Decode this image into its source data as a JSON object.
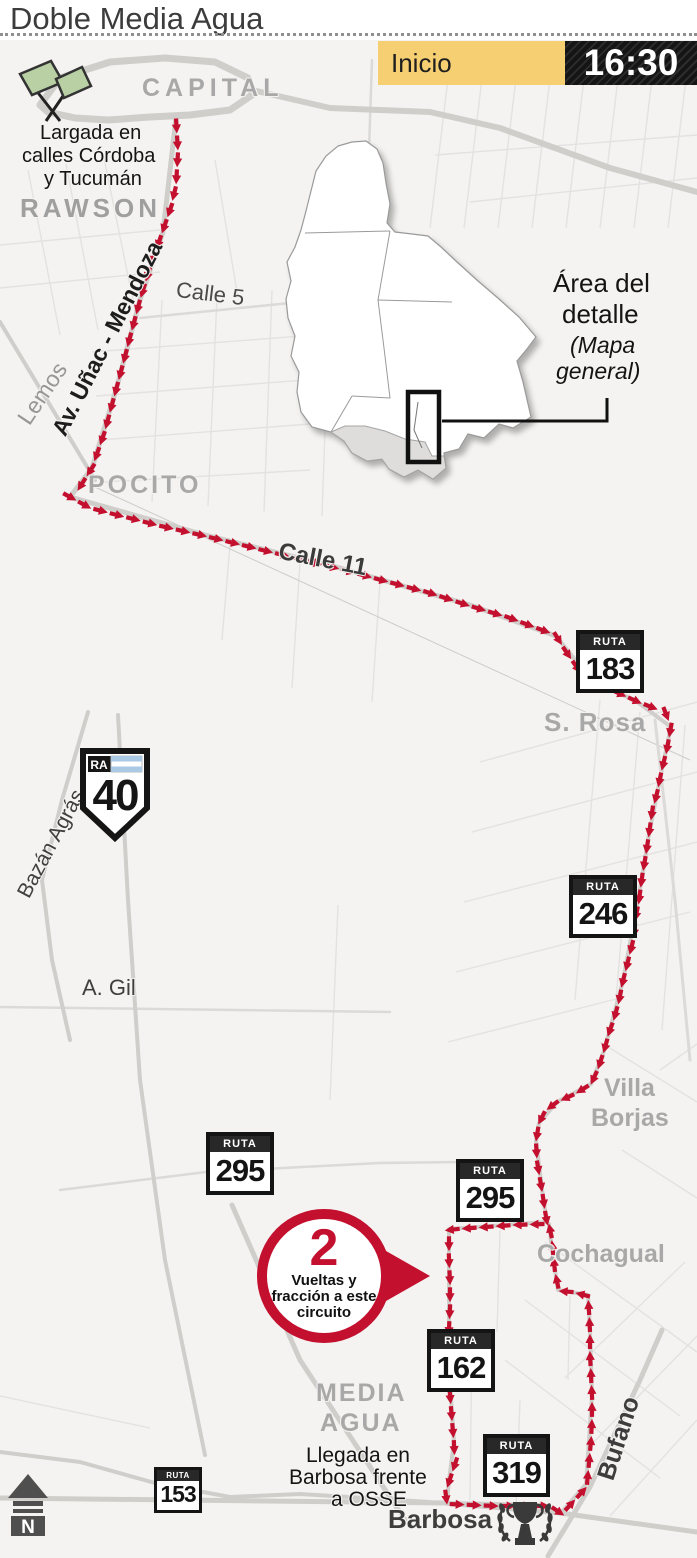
{
  "title": "Doble Media Agua",
  "schedule": {
    "label": "Inicio",
    "time": "16:30"
  },
  "areas": {
    "capital": "CAPITAL",
    "rawson": "RAWSON",
    "pocito": "POCITO",
    "santa_rosa": "S. Rosa",
    "villa_borjas_line1": "Villa",
    "villa_borjas_line2": "Borjas",
    "cochagual": "Cochagual",
    "media_agua_line1": "MEDIA",
    "media_agua_line2": "AGUA",
    "barbosa": "Barbosa"
  },
  "streets": {
    "calle5": "Calle 5",
    "calle11": "Calle 11",
    "lemos": "Lemos",
    "unac": "Av. Uñac - Mendoza",
    "bazan": "Bazán Agrás",
    "agil": "A. Gil",
    "bufano": "Bufano"
  },
  "notes": {
    "start_line1": "Largada en",
    "start_line2": "calles Córdoba",
    "start_line3": "y Tucumán",
    "finish_line1": "Llegada en",
    "finish_line2": "Barbosa frente",
    "finish_line3": "a OSSE",
    "inset_line1": "Área del",
    "inset_line2": "detalle",
    "inset_line3": "(Mapa",
    "inset_line4": "general)"
  },
  "circuit": {
    "laps": "2",
    "line1": "Vueltas y",
    "line2": "fracción a este",
    "line3": "circuito"
  },
  "shields": {
    "ra40": {
      "prefix": "RA",
      "number": "40"
    },
    "r183": {
      "banner": "RUTA",
      "number": "183"
    },
    "r246": {
      "banner": "RUTA",
      "number": "246"
    },
    "r295a": {
      "banner": "RUTA",
      "number": "295"
    },
    "r295b": {
      "banner": "RUTA",
      "number": "295"
    },
    "r162": {
      "banner": "RUTA",
      "number": "162"
    },
    "r319": {
      "banner": "RUTA",
      "number": "319"
    },
    "r153": {
      "banner": "RUTA",
      "number": "153"
    }
  },
  "compass": {
    "letter": "N"
  },
  "colors": {
    "route": "#c3102e",
    "accent_yellow": "#f5cf72",
    "time_bg": "#1d1d1d",
    "map_bg": "#f4f3f1",
    "flag_green": "#b9d0a4",
    "flag_blue": "#a9c9e4"
  }
}
